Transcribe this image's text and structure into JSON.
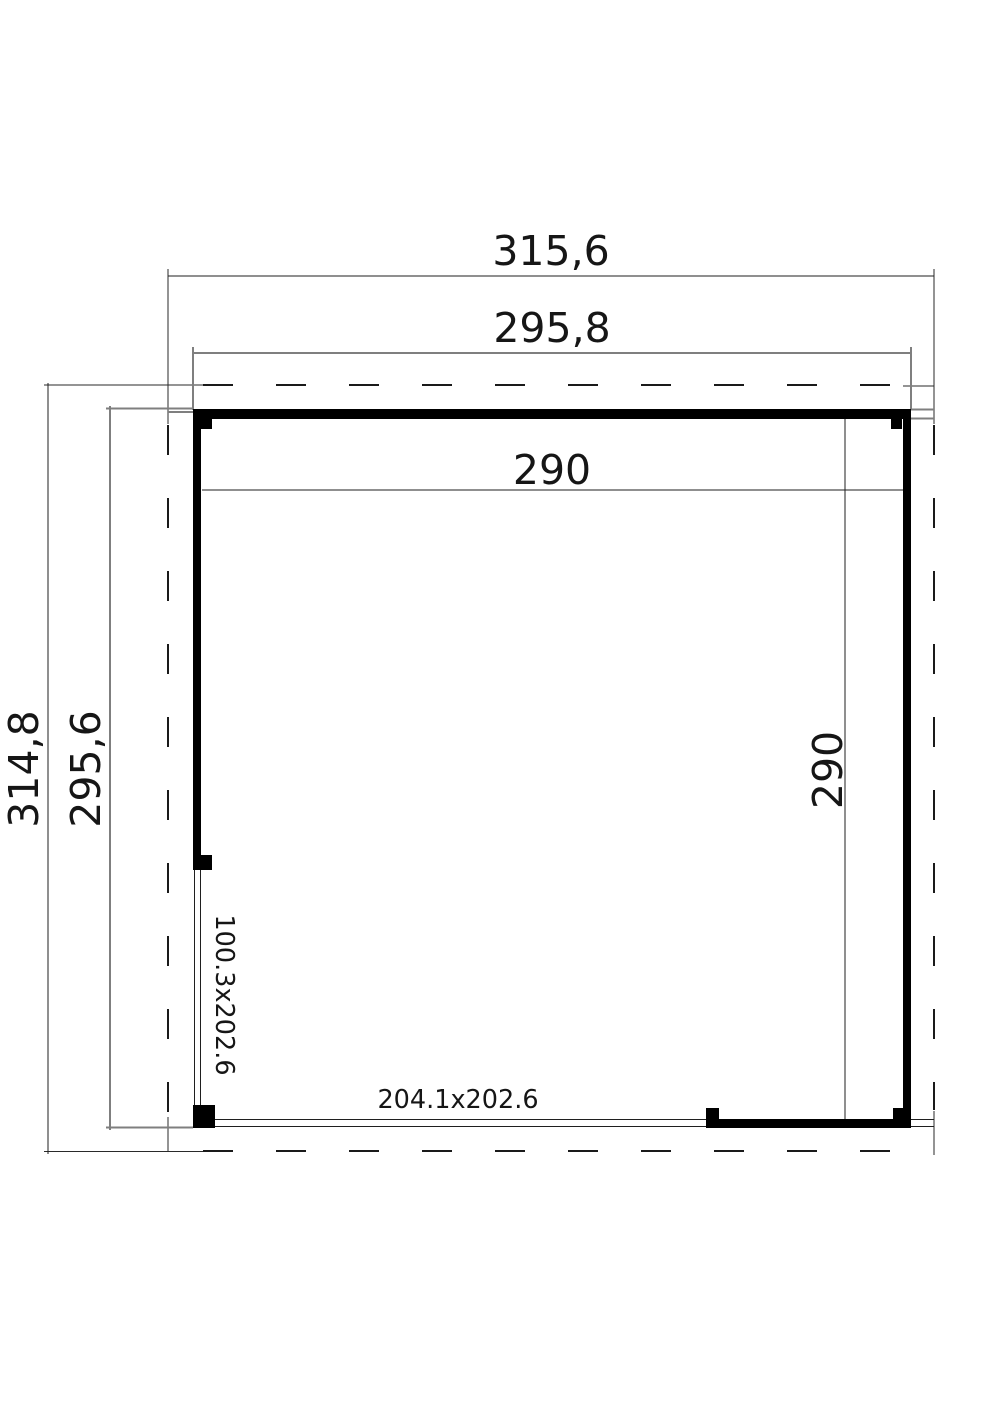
{
  "plan": {
    "background": "#ffffff",
    "line_color": "#1f1f1f",
    "secondary_line_color": "#7f7f7f",
    "wall_color": "#000000",
    "labels": {
      "roof_width": "315,6",
      "wall_width": "295,8",
      "inner_width": "290",
      "roof_depth": "314,8",
      "wall_depth": "295,6",
      "inner_depth": "290",
      "door_opening": "100.3x202.6",
      "front_opening": "204.1x202.6"
    }
  }
}
